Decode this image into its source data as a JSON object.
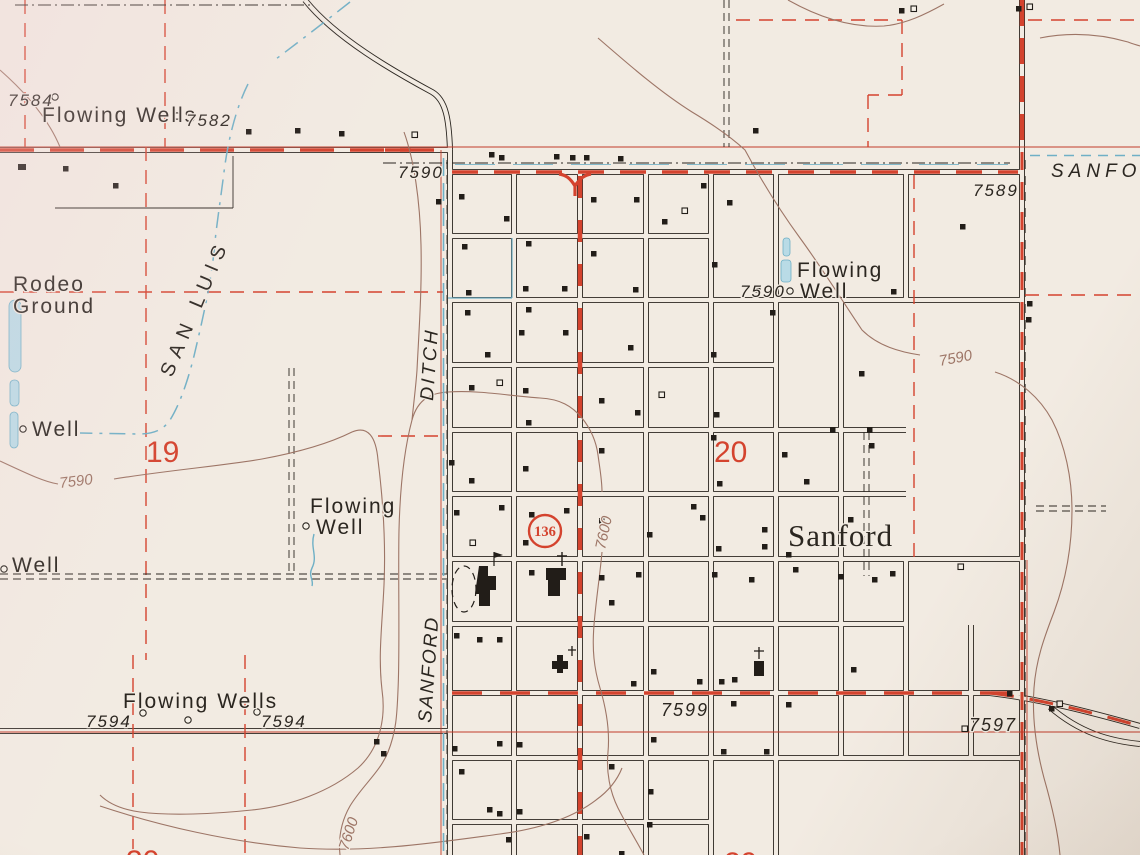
{
  "colors": {
    "paper": "#f2ebe2",
    "ink": "#2b2620",
    "map_red": "#d4432e",
    "red_line": "#c23b2a",
    "contour_brown": "#9d7566",
    "water_blue": "#6fb0c6",
    "water_fill": "#b9dbe6"
  },
  "labels": {
    "fw_nw": "Flowing Wells",
    "e7584": "7584",
    "e7582": "7582",
    "rodeo1": "Rodeo",
    "rodeo2": "Ground",
    "san_luis": "SAN LUIS",
    "well_w": "Well",
    "well_sw": "Well",
    "sec19": "19",
    "sec20": "20",
    "sec29": "29",
    "sec30": "30",
    "c7590w": "7590",
    "c7590e": "7590",
    "c7600m": "7600",
    "c7600s": "7600",
    "fw_c1": "Flowing",
    "fw_c2": "Well",
    "fw_ne1": "Flowing",
    "fw_ne2": "Well",
    "e7590ne": "7590",
    "e7590top": "7590",
    "e7589": "7589",
    "sanfor": "SANFOR",
    "ditch1": "DITCH",
    "ditch2": "SANFORD",
    "shield": "136",
    "town": "Sanford",
    "fw_s": "Flowing Wells",
    "e7594a": "7594",
    "e7594b": "7594",
    "e7599": "7599",
    "e7597": "7597"
  }
}
